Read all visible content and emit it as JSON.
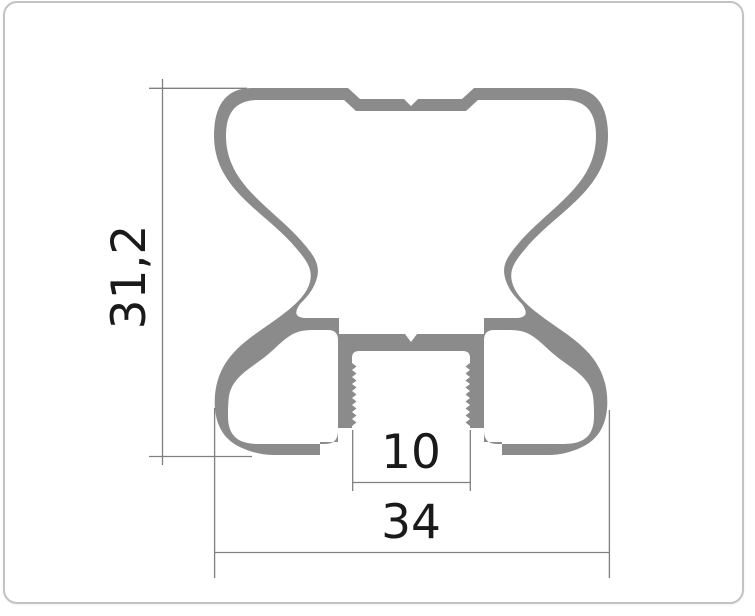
{
  "page": {
    "background": "#ffffff"
  },
  "card": {
    "background": "#ffffff",
    "border_color": "#c2c2c2"
  },
  "drawing": {
    "kind": "extrusion-profile-cross-section",
    "profile_color": "#8b8b8b",
    "dimension_line_color": "#7f7f7f",
    "label_color": "#1a1a1a",
    "dimensions": {
      "overall_height": {
        "label": "31,2",
        "orientation": "vertical"
      },
      "slot_width": {
        "label": "10",
        "orientation": "horizontal"
      },
      "overall_width": {
        "label": "34",
        "orientation": "horizontal"
      }
    }
  }
}
